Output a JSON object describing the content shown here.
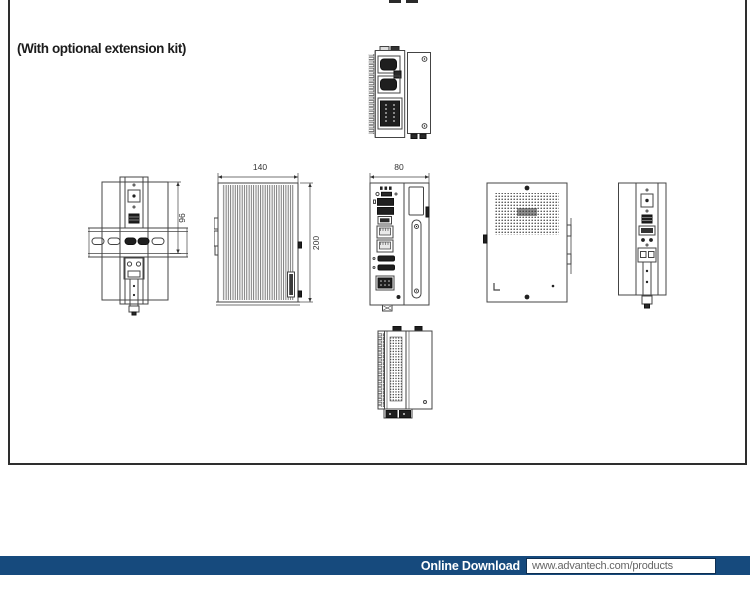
{
  "panel": {
    "note": "(With optional extension kit)"
  },
  "drawing": {
    "dims": {
      "width_front": "140",
      "height_front": "200",
      "depth": "80",
      "rail_height": "96"
    },
    "views": {
      "top": "top-view",
      "din_side": "left-side-view-on-din-rail",
      "heatsink": "heatsink-side-view",
      "front": "front-io-view",
      "rear": "rear-vent-view",
      "right_side": "right-side-view",
      "bottom": "bottom-view"
    }
  },
  "footer": {
    "label": "Online Download",
    "url": "www.advantech.com/products"
  },
  "colors": {
    "line": "#444444",
    "dark_fill": "#1f1f1f",
    "footer_navy": "#164a7d",
    "url_text": "#666666"
  }
}
